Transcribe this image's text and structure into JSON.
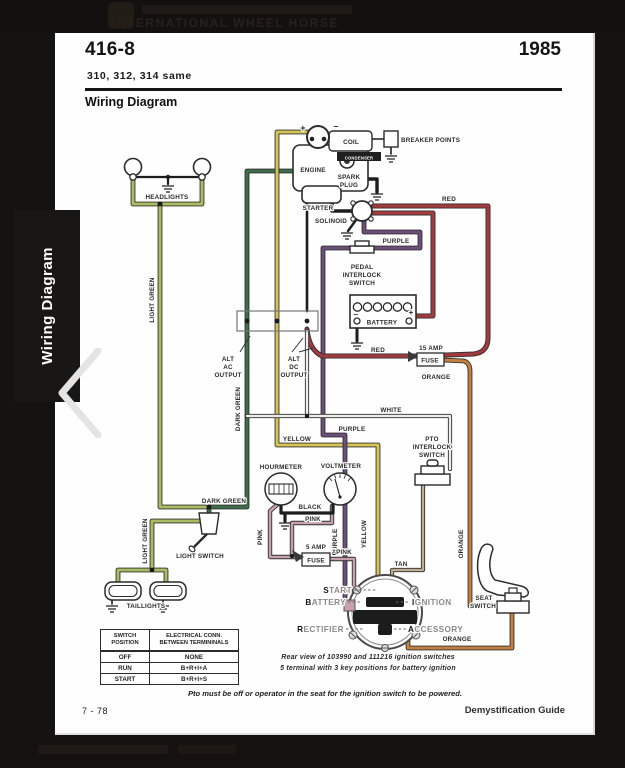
{
  "masthead": {
    "text": "INTERNATIONAL WHEEL HORSE"
  },
  "sidebar": {
    "tab_label": "Wiring Diagram"
  },
  "page": {
    "model": "416-8",
    "year": "1985",
    "subtitle": "310, 312, 314 same",
    "section_title": "Wiring Diagram",
    "footer": {
      "page_number": "7 - 78",
      "guide": "Demystification Guide"
    },
    "notes": {
      "pto_note": "Pto must be off or operator in the seat for the ignition switch to be powered."
    },
    "switch_table": {
      "col1_line1": "SWITCH",
      "col1_line2": "POSITION",
      "col2_line1": "ELECTRICAL CONN.",
      "col2_line2": "BETWEEN TERMININALS",
      "rows": [
        {
          "pos": "OFF",
          "conn": "NONE"
        },
        {
          "pos": "RUN",
          "conn": "B+R+I+A"
        },
        {
          "pos": "START",
          "conn": "B+R+I+S"
        }
      ]
    }
  },
  "diagram": {
    "wire_colors": {
      "red": "#a23a3e",
      "orange": "#c5803f",
      "yellow": "#d6c554",
      "light_green": "#a9bd63",
      "dark_green": "#3e6f48",
      "purple": "#6e4e7d",
      "pink": "#c7a2ae",
      "white": "#ededed",
      "tan": "#bfae92",
      "black": "#1d1d1d"
    },
    "labels": [
      {
        "n": "headlights",
        "t": "HEADLIGHTS",
        "x": 167,
        "y": 199
      },
      {
        "n": "light-green-upper",
        "t": "LIGHT GREEN",
        "x": 154,
        "y": 300,
        "r": -90
      },
      {
        "n": "light-green-lower",
        "t": "LIGHT GREEN",
        "x": 147,
        "y": 541,
        "r": -90
      },
      {
        "n": "dark-green-vertical",
        "t": "DARK GREEN",
        "x": 240,
        "y": 409,
        "r": -90
      },
      {
        "n": "dark-green-horizontal",
        "t": "DARK GREEN",
        "x": 224,
        "y": 503
      },
      {
        "n": "coil",
        "t": "COIL",
        "x": 351,
        "y": 144
      },
      {
        "n": "condenser",
        "t": "CONDENSER",
        "x": 359,
        "y": 159.5,
        "s": 4.2,
        "f": "#ffffff"
      },
      {
        "n": "breaker-points",
        "t": "BREAKER POINTS",
        "x": 401,
        "y": 142,
        "a": "start"
      },
      {
        "n": "engine",
        "t": "ENGINE",
        "x": 313,
        "y": 172
      },
      {
        "n": "spark-plug-1",
        "t": "SPARK",
        "x": 349,
        "y": 179
      },
      {
        "n": "spark-plug-2",
        "t": "PLUG",
        "x": 349,
        "y": 187
      },
      {
        "n": "coil-plus",
        "t": "+",
        "x": 303,
        "y": 131,
        "s": 9,
        "w": 700
      },
      {
        "n": "coil-minus",
        "t": "–",
        "x": 336,
        "y": 129,
        "s": 9,
        "w": 700
      },
      {
        "n": "starter",
        "t": "STARTER",
        "x": 318,
        "y": 210
      },
      {
        "n": "solenoid",
        "t": "SOLINOID",
        "x": 331,
        "y": 223
      },
      {
        "n": "red-top",
        "t": "RED",
        "x": 449,
        "y": 201
      },
      {
        "n": "purple-top",
        "t": "PURPLE",
        "x": 396,
        "y": 243
      },
      {
        "n": "pedal-1",
        "t": "PEDAL",
        "x": 362,
        "y": 269
      },
      {
        "n": "pedal-2",
        "t": "INTERLOCK",
        "x": 362,
        "y": 277
      },
      {
        "n": "pedal-3",
        "t": "SWITCH",
        "x": 362,
        "y": 285
      },
      {
        "n": "battery-minus",
        "t": "–",
        "x": 356,
        "y": 317,
        "s": 8,
        "w": 700
      },
      {
        "n": "battery-plus",
        "t": "+",
        "x": 411,
        "y": 315,
        "s": 8,
        "w": 700
      },
      {
        "n": "battery",
        "t": "BATTERY",
        "x": 382,
        "y": 324.5
      },
      {
        "n": "red-mid",
        "t": "RED",
        "x": 378,
        "y": 352
      },
      {
        "n": "fuse15-amp",
        "t": "15 AMP",
        "x": 431,
        "y": 350
      },
      {
        "n": "fuse15",
        "t": "FUSE",
        "x": 430,
        "y": 362.5
      },
      {
        "n": "orange-top",
        "t": "ORANGE",
        "x": 436,
        "y": 379
      },
      {
        "n": "alt-ac-1",
        "t": "ALT",
        "x": 228,
        "y": 361
      },
      {
        "n": "alt-ac-2",
        "t": "AC",
        "x": 228,
        "y": 369
      },
      {
        "n": "alt-ac-3",
        "t": "OUTPUT",
        "x": 228,
        "y": 377
      },
      {
        "n": "alt-dc-1",
        "t": "ALT",
        "x": 294,
        "y": 361
      },
      {
        "n": "alt-dc-2",
        "t": "DC",
        "x": 294,
        "y": 369
      },
      {
        "n": "alt-dc-3",
        "t": "OUTPUT",
        "x": 294,
        "y": 377
      },
      {
        "n": "white",
        "t": "WHITE",
        "x": 391,
        "y": 412
      },
      {
        "n": "purple-mid",
        "t": "PURPLE",
        "x": 352,
        "y": 431
      },
      {
        "n": "yellow-mid",
        "t": "YELLOW",
        "x": 297,
        "y": 441
      },
      {
        "n": "pto-1",
        "t": "PTO",
        "x": 432,
        "y": 441
      },
      {
        "n": "pto-2",
        "t": "INTERLOCK",
        "x": 432,
        "y": 449
      },
      {
        "n": "pto-3",
        "t": "SWITCH",
        "x": 432,
        "y": 457
      },
      {
        "n": "hourmeter",
        "t": "HOURMETER",
        "x": 281,
        "y": 469
      },
      {
        "n": "voltmeter",
        "t": "VOLTMETER",
        "x": 341,
        "y": 468
      },
      {
        "n": "black",
        "t": "BLACK",
        "x": 310,
        "y": 509
      },
      {
        "n": "pink-horizontal",
        "t": "PINK",
        "x": 313,
        "y": 521
      },
      {
        "n": "pink-vertical",
        "t": "PINK",
        "x": 262,
        "y": 537,
        "r": -90
      },
      {
        "n": "purple-vertical",
        "t": "PURPLE",
        "x": 337,
        "y": 542,
        "r": -90
      },
      {
        "n": "yellow-vertical",
        "t": "YELLOW",
        "x": 366,
        "y": 534,
        "r": -90
      },
      {
        "n": "orange-vertical",
        "t": "ORANGE",
        "x": 463,
        "y": 544,
        "r": -90
      },
      {
        "n": "fuse5-amp",
        "t": "5 AMP",
        "x": 316,
        "y": 549
      },
      {
        "n": "fuse5",
        "t": "FUSE",
        "x": 316,
        "y": 562.5
      },
      {
        "n": "pink-fuse",
        "t": "PINK",
        "x": 344,
        "y": 554
      },
      {
        "n": "tan",
        "t": "TAN",
        "x": 401,
        "y": 566
      },
      {
        "n": "light-switch",
        "t": "LIGHT SWITCH",
        "x": 200,
        "y": 558
      },
      {
        "n": "taillights",
        "t": "TAILLIGHTS",
        "x": 146,
        "y": 608
      },
      {
        "n": "seat-switch-1",
        "t": "SEAT",
        "x": 484,
        "y": 600
      },
      {
        "n": "seat-switch-2",
        "t": "SWITCH",
        "x": 483,
        "y": 608
      },
      {
        "n": "orange-bottom",
        "t": "ORANGE",
        "x": 457,
        "y": 641
      },
      {
        "n": "ignition-note-1",
        "t": "Rear view of 103990 and 111216 ignition switches",
        "x": 368,
        "y": 659,
        "s": 7,
        "w": 700,
        "i": 1
      },
      {
        "n": "ignition-note-2",
        "t": "5 terminal with 3 key positions for battery ignition",
        "x": 368,
        "y": 670,
        "s": 7,
        "w": 700,
        "i": 1
      }
    ],
    "ignition_labels": [
      {
        "n": "start",
        "lead": "S",
        "rest": "TART",
        "x": 352,
        "y": 593,
        "a": "end"
      },
      {
        "n": "battery",
        "lead": "B",
        "rest": "ATTERY",
        "x": 346,
        "y": 605,
        "a": "end"
      },
      {
        "n": "rectifier",
        "lead": "R",
        "rest": "ECTIFIER",
        "x": 344,
        "y": 632,
        "a": "end"
      },
      {
        "n": "ignition",
        "lead": "I",
        "rest": "GNITION",
        "x": 412,
        "y": 605,
        "a": "start"
      },
      {
        "n": "accessory",
        "lead": "A",
        "rest": "CCESSORY",
        "x": 408,
        "y": 632,
        "a": "start"
      }
    ]
  }
}
